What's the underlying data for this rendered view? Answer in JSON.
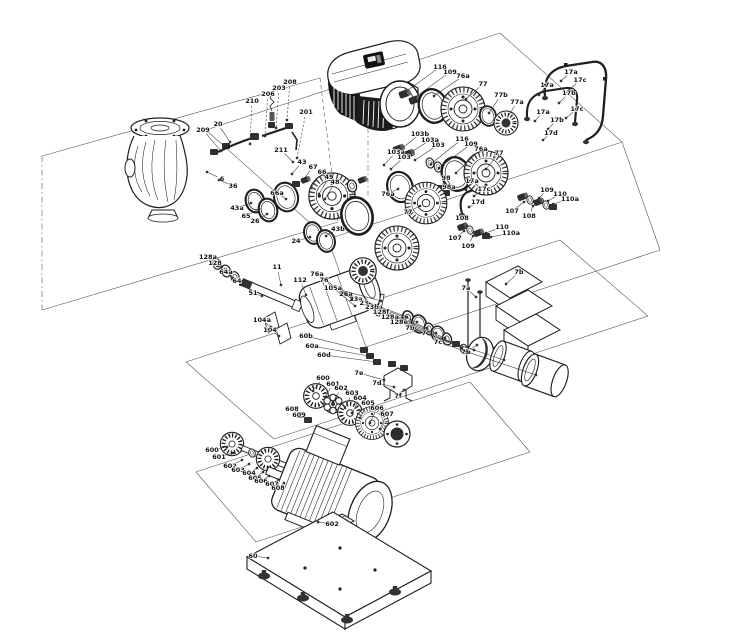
{
  "diagram": {
    "type": "exploded-parts-diagram",
    "subject": "pump assembly exploded view",
    "colors": {
      "background": "#ffffff",
      "line": "#333333",
      "label": "#111111",
      "part_stroke": "#1e1e1e",
      "motor_dark": "#161616"
    },
    "callouts": [
      {
        "t": "210",
        "x": 252,
        "y": 101,
        "ax": 250,
        "ay": 144,
        "d": 1
      },
      {
        "t": "206",
        "x": 268,
        "y": 94,
        "ax": 265,
        "ay": 136,
        "d": 1
      },
      {
        "t": "203",
        "x": 279,
        "y": 88,
        "ax": 276,
        "ay": 128,
        "d": 1
      },
      {
        "t": "208",
        "x": 290,
        "y": 82,
        "ax": 287,
        "ay": 120,
        "d": 1
      },
      {
        "t": "201",
        "x": 306,
        "y": 112,
        "ax": 297,
        "ay": 158,
        "d": 1
      },
      {
        "t": "211",
        "x": 281,
        "y": 150,
        "ax": 293,
        "ay": 162
      },
      {
        "t": "20",
        "x": 218,
        "y": 124,
        "ax": 230,
        "ay": 142
      },
      {
        "t": "209",
        "x": 203,
        "y": 130,
        "ax": 221,
        "ay": 151
      },
      {
        "t": "6",
        "x": 222,
        "y": 179,
        "ax": 207,
        "ay": 172
      },
      {
        "t": "36",
        "x": 233,
        "y": 186,
        "ax": 219,
        "ay": 180
      },
      {
        "t": "43a",
        "x": 237,
        "y": 208,
        "ax": 251,
        "ay": 203
      },
      {
        "t": "65",
        "x": 246,
        "y": 216,
        "ax": 259,
        "ay": 209
      },
      {
        "t": "26",
        "x": 255,
        "y": 221,
        "ax": 267,
        "ay": 214
      },
      {
        "t": "66a",
        "x": 277,
        "y": 193,
        "ax": 286,
        "ay": 199
      },
      {
        "t": "43",
        "x": 302,
        "y": 162,
        "ax": 292,
        "ay": 174
      },
      {
        "t": "67",
        "x": 313,
        "y": 167,
        "ax": 302,
        "ay": 181
      },
      {
        "t": "66",
        "x": 322,
        "y": 172,
        "ax": 311,
        "ay": 188
      },
      {
        "t": "49",
        "x": 329,
        "y": 177,
        "ax": 319,
        "ay": 194
      },
      {
        "t": "48",
        "x": 335,
        "y": 182,
        "ax": 325,
        "ay": 199
      },
      {
        "t": "24",
        "x": 296,
        "y": 241,
        "ax": 310,
        "ay": 237
      },
      {
        "t": "43b",
        "x": 338,
        "y": 229,
        "ax": 326,
        "ay": 236
      },
      {
        "t": "116",
        "x": 440,
        "y": 67,
        "ax": 404,
        "ay": 93
      },
      {
        "t": "109",
        "x": 450,
        "y": 72,
        "ax": 413,
        "ay": 99
      },
      {
        "t": "76a",
        "x": 463,
        "y": 76,
        "ax": 434,
        "ay": 96
      },
      {
        "t": "77",
        "x": 483,
        "y": 84,
        "ax": 466,
        "ay": 99
      },
      {
        "t": "77b",
        "x": 501,
        "y": 95,
        "ax": 489,
        "ay": 113
      },
      {
        "t": "77a",
        "x": 517,
        "y": 102,
        "ax": 506,
        "ay": 120
      },
      {
        "t": "17a",
        "x": 571,
        "y": 72,
        "ax": 561,
        "ay": 81
      },
      {
        "t": "17c",
        "x": 580,
        "y": 80,
        "ax": 569,
        "ay": 90
      },
      {
        "t": "17a",
        "x": 547,
        "y": 85,
        "ax": 539,
        "ay": 95
      },
      {
        "t": "17b",
        "x": 569,
        "y": 93,
        "ax": 559,
        "ay": 103
      },
      {
        "t": "17c",
        "x": 577,
        "y": 109,
        "ax": 566,
        "ay": 118
      },
      {
        "t": "17a",
        "x": 543,
        "y": 112,
        "ax": 535,
        "ay": 121
      },
      {
        "t": "17b",
        "x": 557,
        "y": 120,
        "ax": 548,
        "ay": 129
      },
      {
        "t": "17d",
        "x": 551,
        "y": 133,
        "ax": 543,
        "ay": 140
      },
      {
        "t": "103b",
        "x": 420,
        "y": 134,
        "ax": 400,
        "ay": 150
      },
      {
        "t": "103a",
        "x": 430,
        "y": 140,
        "ax": 407,
        "ay": 155
      },
      {
        "t": "103",
        "x": 438,
        "y": 145,
        "ax": 415,
        "ay": 160
      },
      {
        "t": "116",
        "x": 462,
        "y": 139,
        "ax": 431,
        "ay": 164
      },
      {
        "t": "109",
        "x": 471,
        "y": 144,
        "ax": 439,
        "ay": 168
      },
      {
        "t": "76a",
        "x": 481,
        "y": 149,
        "ax": 456,
        "ay": 173
      },
      {
        "t": "77",
        "x": 499,
        "y": 153,
        "ax": 486,
        "ay": 169
      },
      {
        "t": "98",
        "x": 446,
        "y": 178,
        "ax": 441,
        "ay": 187
      },
      {
        "t": "98a",
        "x": 449,
        "y": 187,
        "ax": 445,
        "ay": 192
      },
      {
        "t": "17a",
        "x": 472,
        "y": 181,
        "ax": 466,
        "ay": 190
      },
      {
        "t": "17c",
        "x": 484,
        "y": 189,
        "ax": 474,
        "ay": 196
      },
      {
        "t": "17d",
        "x": 478,
        "y": 202,
        "ax": 469,
        "ay": 207
      },
      {
        "t": "76a",
        "x": 388,
        "y": 194,
        "ax": 398,
        "ay": 189
      },
      {
        "t": "77",
        "x": 408,
        "y": 212,
        "ax": 420,
        "ay": 206
      },
      {
        "t": "103a",
        "x": 396,
        "y": 152,
        "ax": 384,
        "ay": 165
      },
      {
        "t": "103",
        "x": 404,
        "y": 157,
        "ax": 391,
        "ay": 169
      },
      {
        "t": "109",
        "x": 547,
        "y": 190,
        "ax": 539,
        "ay": 198
      },
      {
        "t": "110",
        "x": 560,
        "y": 194,
        "ax": 548,
        "ay": 201
      },
      {
        "t": "110a",
        "x": 570,
        "y": 199,
        "ax": 553,
        "ay": 204
      },
      {
        "t": "107",
        "x": 512,
        "y": 211,
        "ax": 524,
        "ay": 202
      },
      {
        "t": "108",
        "x": 529,
        "y": 216,
        "ax": 533,
        "ay": 206
      },
      {
        "t": "110",
        "x": 502,
        "y": 227,
        "ax": 486,
        "ay": 233
      },
      {
        "t": "110a",
        "x": 511,
        "y": 233,
        "ax": 491,
        "ay": 237
      },
      {
        "t": "107",
        "x": 455,
        "y": 238,
        "ax": 464,
        "ay": 231
      },
      {
        "t": "109",
        "x": 468,
        "y": 246,
        "ax": 473,
        "ay": 236
      },
      {
        "t": "108",
        "x": 462,
        "y": 218,
        "ax": 467,
        "ay": 226
      },
      {
        "t": "7b",
        "x": 519,
        "y": 272,
        "ax": 506,
        "ay": 284
      },
      {
        "t": "7a",
        "x": 466,
        "y": 288,
        "ax": 476,
        "ay": 297
      },
      {
        "t": "7b",
        "x": 466,
        "y": 352,
        "ax": 477,
        "ay": 345
      },
      {
        "t": "26a",
        "x": 346,
        "y": 294,
        "ax": 407,
        "ay": 317
      },
      {
        "t": "23a",
        "x": 356,
        "y": 299,
        "ax": 417,
        "ay": 322
      },
      {
        "t": "23",
        "x": 364,
        "y": 303,
        "ax": 427,
        "ay": 328
      },
      {
        "t": "23b",
        "x": 372,
        "y": 307,
        "ax": 436,
        "ay": 333
      },
      {
        "t": "128f",
        "x": 381,
        "y": 312,
        "ax": 445,
        "ay": 338
      },
      {
        "t": "128a",
        "x": 390,
        "y": 317,
        "ax": 454,
        "ay": 343
      },
      {
        "t": "128e",
        "x": 399,
        "y": 322,
        "ax": 462,
        "ay": 348
      },
      {
        "t": "7b",
        "x": 410,
        "y": 328,
        "ax": 474,
        "ay": 350
      },
      {
        "t": "7",
        "x": 424,
        "y": 333,
        "ax": 504,
        "ay": 360
      },
      {
        "t": "7c",
        "x": 438,
        "y": 342,
        "ax": 536,
        "ay": 375
      },
      {
        "t": "7e",
        "x": 359,
        "y": 373,
        "ax": 384,
        "ay": 380
      },
      {
        "t": "7d",
        "x": 377,
        "y": 383,
        "ax": 394,
        "ay": 387
      },
      {
        "t": "7f",
        "x": 398,
        "y": 396,
        "ax": 404,
        "ay": 390
      },
      {
        "t": "128a",
        "x": 208,
        "y": 257,
        "ax": 218,
        "ay": 266
      },
      {
        "t": "128",
        "x": 215,
        "y": 263,
        "ax": 225,
        "ay": 271
      },
      {
        "t": "64a",
        "x": 226,
        "y": 272,
        "ax": 233,
        "ay": 278
      },
      {
        "t": "64",
        "x": 237,
        "y": 281,
        "ax": 242,
        "ay": 285
      },
      {
        "t": "51",
        "x": 253,
        "y": 293,
        "ax": 262,
        "ay": 296
      },
      {
        "t": "11",
        "x": 277,
        "y": 267,
        "ax": 281,
        "ay": 285
      },
      {
        "t": "112",
        "x": 300,
        "y": 280,
        "ax": 306,
        "ay": 295
      },
      {
        "t": "76a",
        "x": 317,
        "y": 274,
        "ax": 352,
        "ay": 299
      },
      {
        "t": "76",
        "x": 324,
        "y": 280,
        "ax": 355,
        "ay": 306
      },
      {
        "t": "105a",
        "x": 333,
        "y": 288,
        "ax": 381,
        "ay": 301
      },
      {
        "t": "104a",
        "x": 262,
        "y": 320,
        "ax": 271,
        "ay": 327
      },
      {
        "t": "104",
        "x": 270,
        "y": 330,
        "ax": 279,
        "ay": 336
      },
      {
        "t": "60b",
        "x": 306,
        "y": 336,
        "ax": 363,
        "ay": 350
      },
      {
        "t": "60a",
        "x": 312,
        "y": 346,
        "ax": 369,
        "ay": 356
      },
      {
        "t": "60d",
        "x": 324,
        "y": 355,
        "ax": 377,
        "ay": 362
      },
      {
        "t": "600",
        "x": 323,
        "y": 378,
        "ax": 313,
        "ay": 391
      },
      {
        "t": "601",
        "x": 333,
        "y": 384,
        "ax": 325,
        "ay": 397
      },
      {
        "t": "602",
        "x": 341,
        "y": 388,
        "ax": 333,
        "ay": 402
      },
      {
        "t": "603",
        "x": 352,
        "y": 393,
        "ax": 345,
        "ay": 408
      },
      {
        "t": "604",
        "x": 360,
        "y": 398,
        "ax": 352,
        "ay": 413
      },
      {
        "t": "605",
        "x": 368,
        "y": 403,
        "ax": 360,
        "ay": 418
      },
      {
        "t": "606",
        "x": 377,
        "y": 408,
        "ax": 370,
        "ay": 423
      },
      {
        "t": "607",
        "x": 387,
        "y": 414,
        "ax": 380,
        "ay": 429
      },
      {
        "t": "608",
        "x": 292,
        "y": 409,
        "ax": 301,
        "ay": 414
      },
      {
        "t": "609",
        "x": 299,
        "y": 415,
        "ax": 307,
        "ay": 420
      },
      {
        "t": "600",
        "x": 212,
        "y": 450,
        "ax": 227,
        "ay": 447
      },
      {
        "t": "601",
        "x": 219,
        "y": 457,
        "ax": 233,
        "ay": 453
      },
      {
        "t": "602",
        "x": 230,
        "y": 466,
        "ax": 242,
        "ay": 460
      },
      {
        "t": "603",
        "x": 238,
        "y": 470,
        "ax": 249,
        "ay": 464
      },
      {
        "t": "604",
        "x": 249,
        "y": 473,
        "ax": 257,
        "ay": 468
      },
      {
        "t": "605",
        "x": 255,
        "y": 478,
        "ax": 263,
        "ay": 472
      },
      {
        "t": "606",
        "x": 261,
        "y": 481,
        "ax": 269,
        "ay": 476
      },
      {
        "t": "607",
        "x": 272,
        "y": 484,
        "ax": 278,
        "ay": 480
      },
      {
        "t": "608",
        "x": 278,
        "y": 488,
        "ax": 284,
        "ay": 483
      },
      {
        "t": "602",
        "x": 332,
        "y": 524,
        "ax": 318,
        "ay": 522
      },
      {
        "t": "60",
        "x": 253,
        "y": 556,
        "ax": 268,
        "ay": 558
      }
    ]
  }
}
